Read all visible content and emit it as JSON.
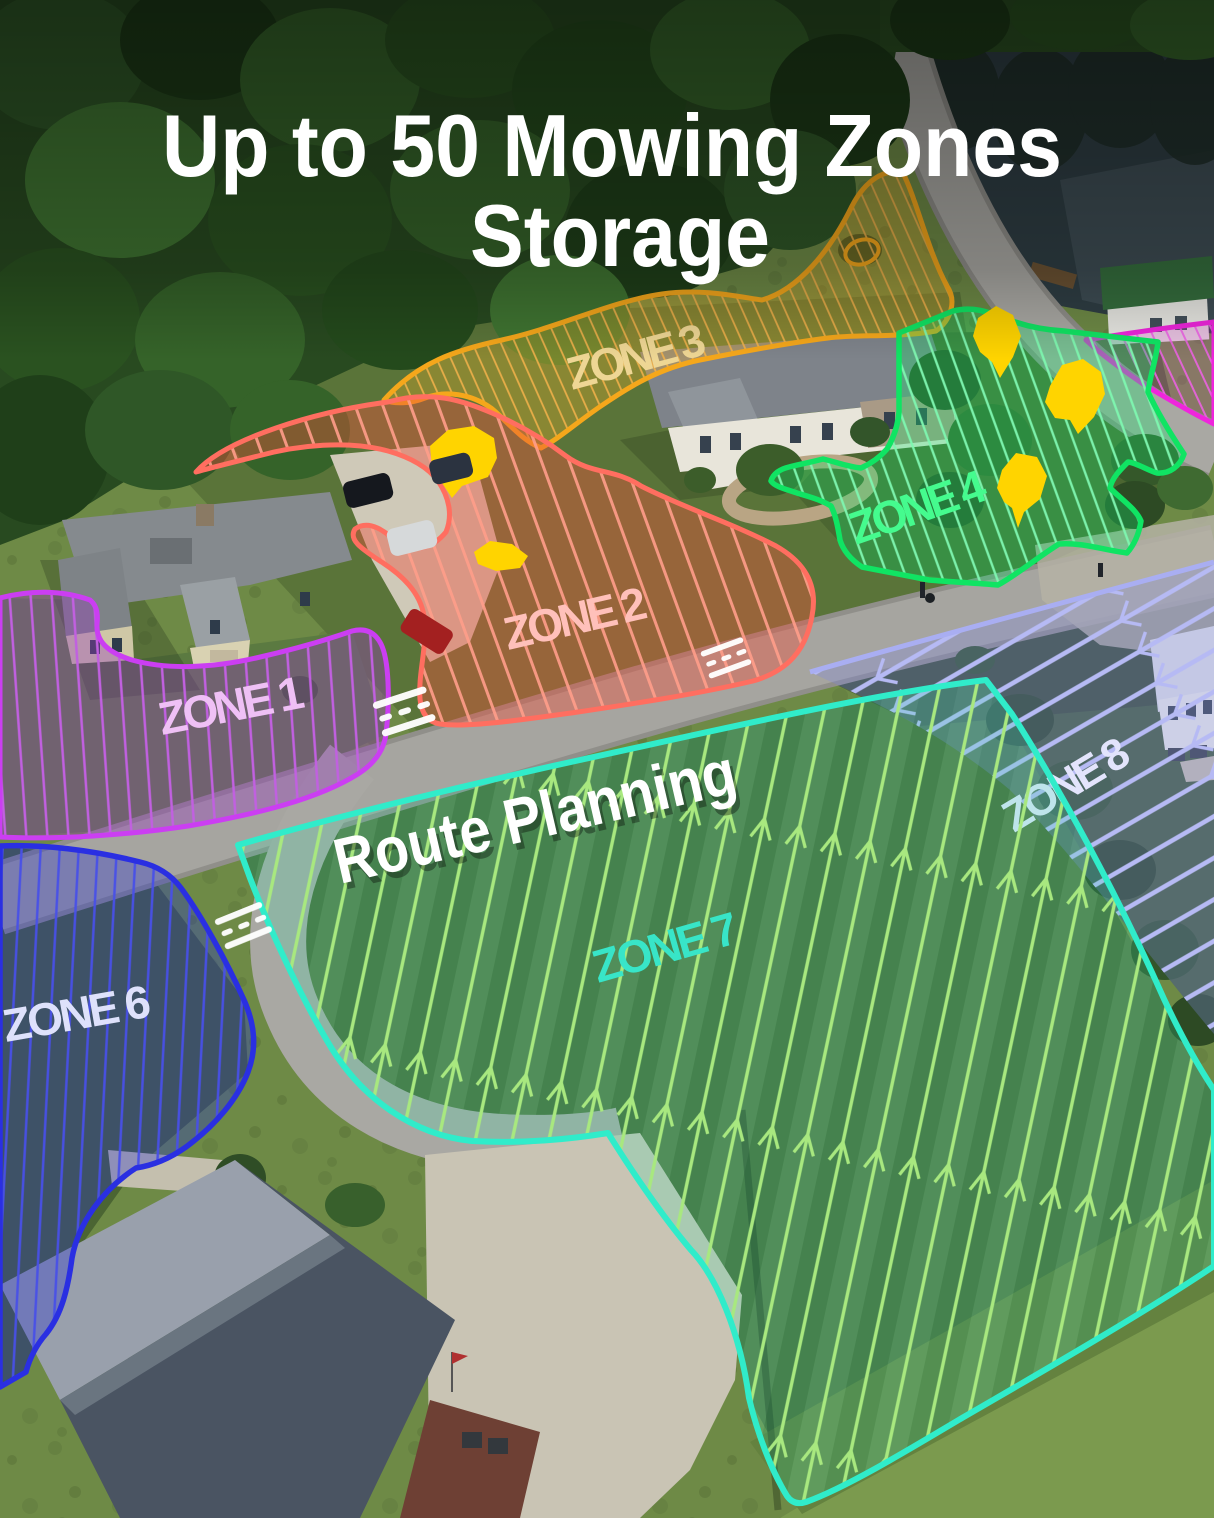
{
  "title": {
    "line1": "Up to 50 Mowing Zones",
    "line2": "Storage"
  },
  "route_planning_label": "Route Planning",
  "zones": [
    {
      "id": "zone1",
      "label": "ZONE 1",
      "outline_color": "#cb3ef2",
      "label_color": "#efc0f5",
      "line_color": "#c160e0",
      "pattern": "parallel-stripes"
    },
    {
      "id": "zone2",
      "label": "ZONE 2",
      "outline_color": "#ff6e60",
      "label_color": "#ffc0ba",
      "line_color": "#ff9d8a",
      "pattern": "diagonal-stripes"
    },
    {
      "id": "zone3",
      "label": "ZONE 3",
      "outline_color": "#f5a71b",
      "label_color": "#eed694",
      "line_color": "#f2b24a",
      "pattern": "diagonal-stripes"
    },
    {
      "id": "zone4",
      "label": "ZONE 4",
      "outline_color": "#10e463",
      "label_color": "#45fb8e",
      "line_color": "#7ef7b0",
      "pattern": "route-stripes"
    },
    {
      "id": "zone5-unlabeled",
      "outline_color": "#ef25dc",
      "line_color": "#f060e8",
      "pattern": "diagonal-stripes"
    },
    {
      "id": "zone6",
      "label": "ZONE 6",
      "outline_color": "#2a2fe2",
      "label_color": "#dee1fb",
      "line_color": "#4750e8",
      "pattern": "route-stripes"
    },
    {
      "id": "zone7",
      "label": "ZONE 7",
      "outline_color": "#30ecca",
      "label_color": "#38e5c8",
      "line_color": "#a8e87f",
      "pattern": "route-stripes-with-arrows"
    },
    {
      "id": "zone8",
      "label": "ZONE 8",
      "outline_color": "#a9aef2",
      "label_color": "#e3e4fc",
      "line_color": "#b6baf4",
      "pattern": "route-stripes-with-branches"
    }
  ],
  "obstacle_marker_color": "#ffd400"
}
